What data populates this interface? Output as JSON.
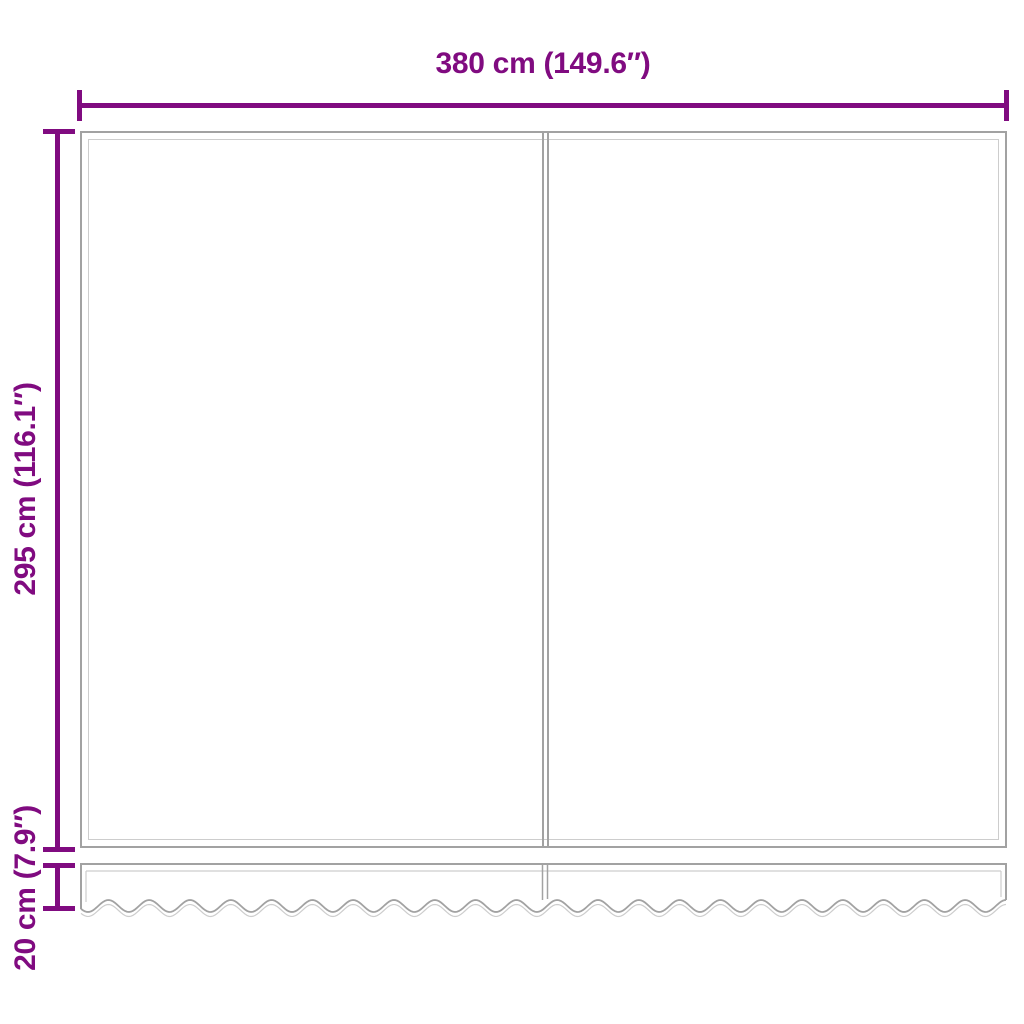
{
  "diagram": {
    "type": "product-dimension-diagram",
    "subject": "awning-replacement-fabric-with-valance",
    "dimensions": {
      "width": {
        "label": "380 cm (149.6″)",
        "value_cm": 380,
        "value_in": 149.6
      },
      "height": {
        "label": "295 cm (116.1″)",
        "value_cm": 295,
        "value_in": 116.1
      },
      "valance_height": {
        "label": "20 cm (7.9″)",
        "value_cm": 20,
        "value_in": 7.9
      }
    },
    "colors": {
      "dimension_color": "#800b80",
      "outline_color": "#a2a2a2",
      "outline_light_color": "#cdcdcd",
      "background_color": "#ffffff"
    }
  }
}
